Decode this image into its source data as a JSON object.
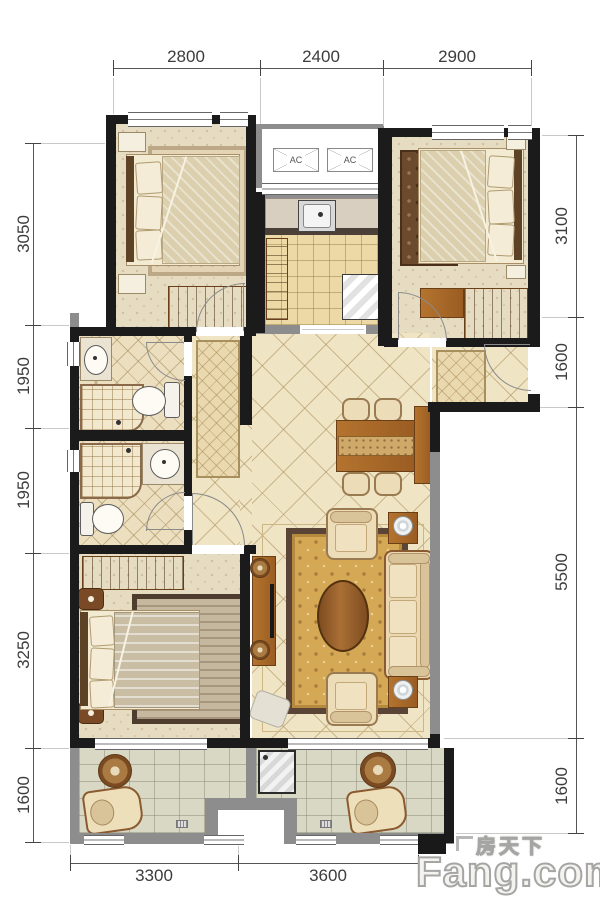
{
  "dimensions": {
    "top": [
      "2800",
      "2400",
      "2900"
    ],
    "left": [
      "3050",
      "1950",
      "1950",
      "3250",
      "1600"
    ],
    "right": [
      "3100",
      "1600",
      "5500",
      "1600"
    ],
    "bottom": [
      "3300",
      "3600"
    ]
  },
  "ac_units": {
    "left": "AC",
    "right": "AC"
  },
  "watermark": {
    "chinese": "房天下",
    "english": "Fang.com"
  },
  "colors": {
    "exterior_wall": "#1b1b1b",
    "partition_wall": "#8d8d8d",
    "wood_furniture": "#a9682f",
    "diamond_tile": "#efe4c4",
    "carpet": "#e6dcc2",
    "living_rug": "#d4a855",
    "dimension_text": "#3c3c3c",
    "watermark_text": "#f4f3ef"
  }
}
